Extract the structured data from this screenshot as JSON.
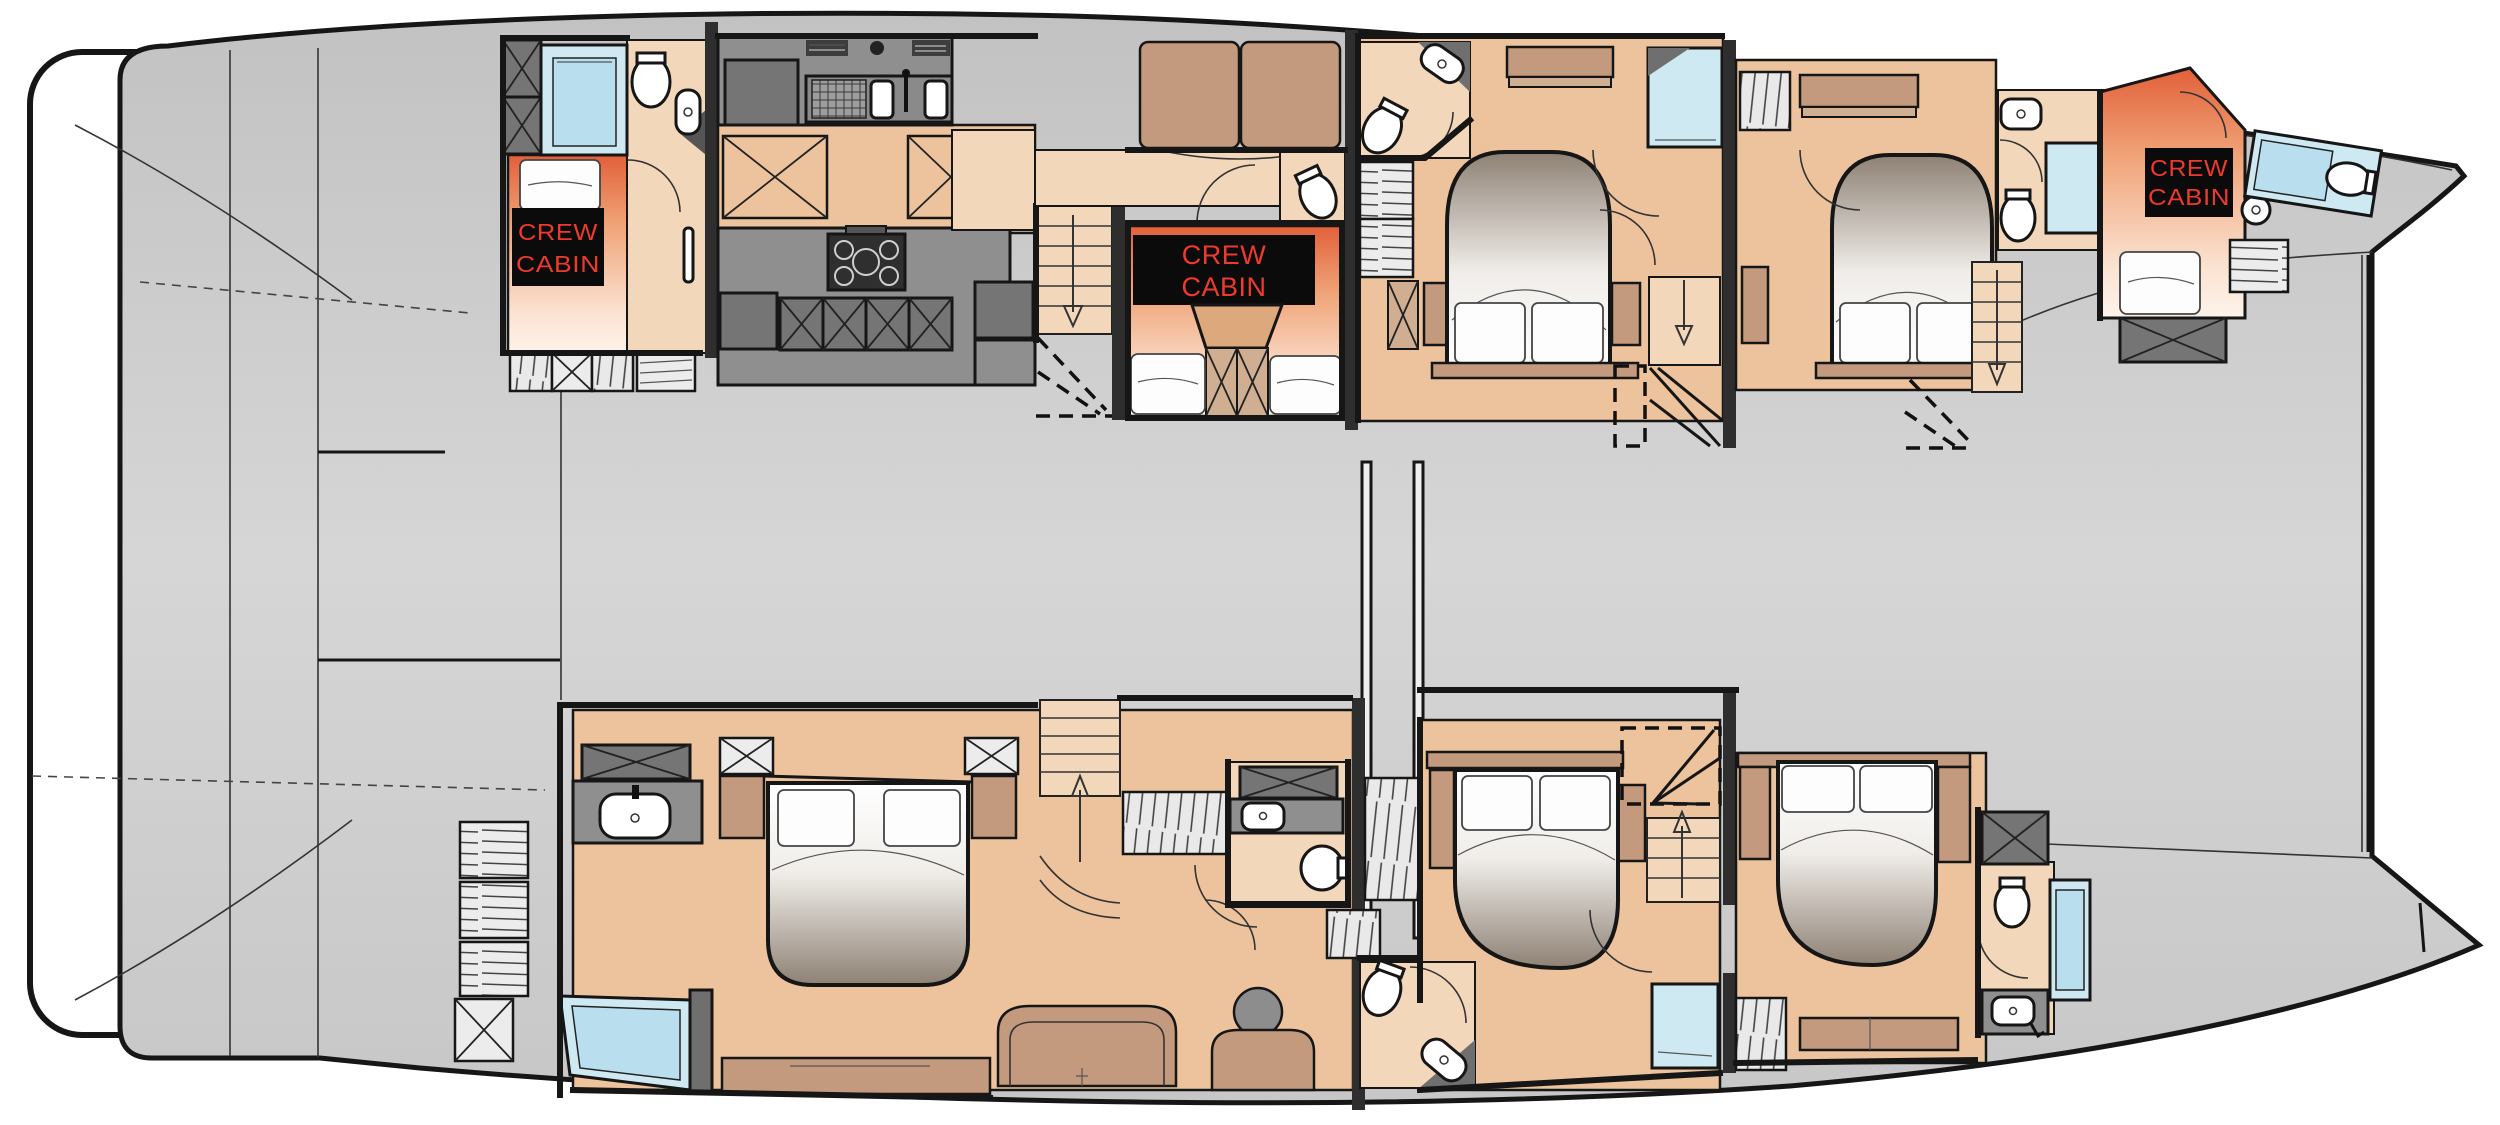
{
  "title": "Catamaran yacht lower deck floor plan",
  "labels": {
    "aft_crew": {
      "line1": "CREW",
      "line2": "CABIN"
    },
    "mid_crew": {
      "line1": "CREW",
      "line2": "CABIN"
    },
    "bow_crew": {
      "line1": "CREW",
      "line2": "CABIN"
    }
  },
  "colors": {
    "deck": "#c9c9c9",
    "floor": "#ecc39c",
    "floor-light": "#f3d7ba",
    "wood": "#c49a7e",
    "dark": "#757575",
    "counter": "#8f8f8f",
    "window": "#cfe9f2",
    "label-bg": "#0b0b0b",
    "accent-red": "#ee3a2c",
    "outline": "#161616"
  },
  "rooms": {
    "port_hull": [
      "aft crew cabin",
      "galley",
      "midship crew cabin",
      "guest cabin 1",
      "guest cabin 2",
      "bow crew cabin"
    ],
    "starboard_hull": [
      "master cabin",
      "master bathroom",
      "guest cabin 3",
      "guest cabin 4",
      "bow head"
    ]
  }
}
